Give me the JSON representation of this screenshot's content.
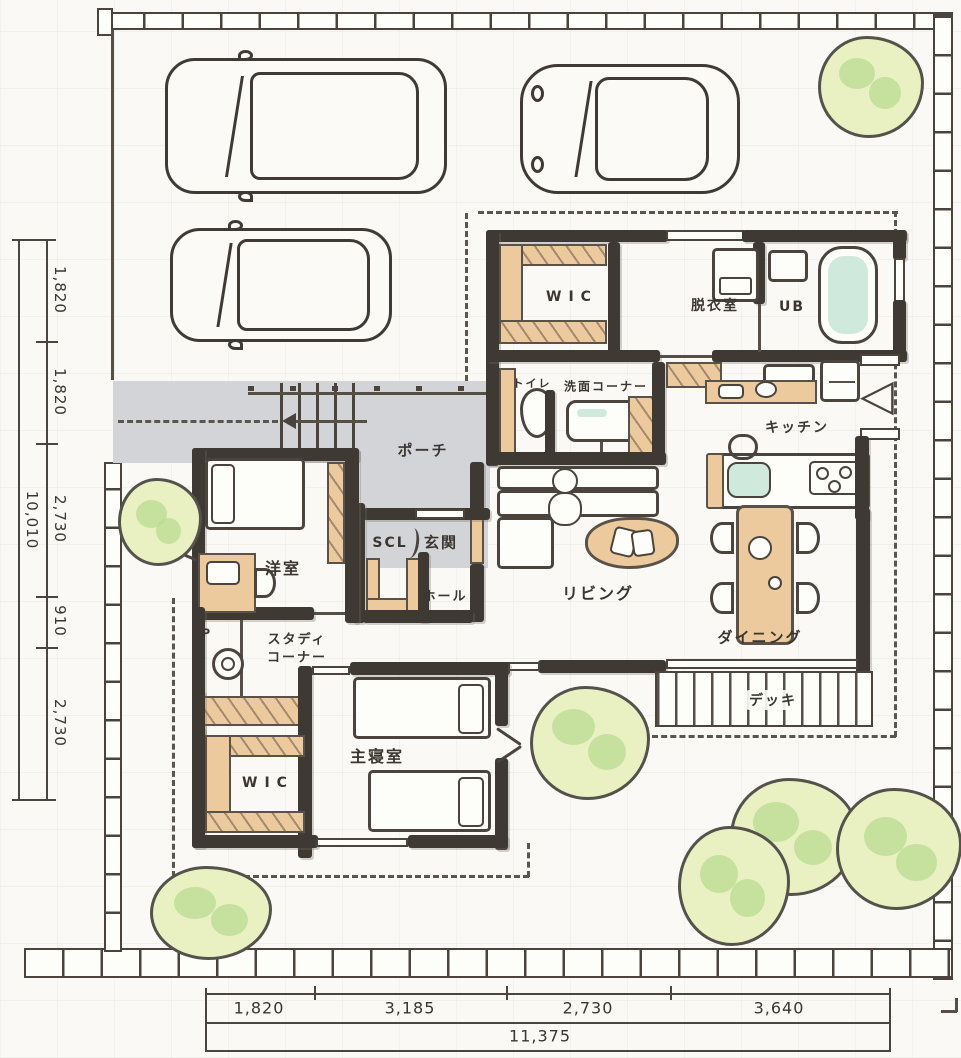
{
  "drawing_type": "hand-drawn residential floor plan (1F site plan)",
  "labels": {
    "wic_north": "WIC",
    "dressing": "脱衣室",
    "bath": "UB",
    "toilet": "トイレ",
    "washroom": "洗面コーナー",
    "kitchen": "キッチン",
    "porch": "ポーチ",
    "shoe_closet": "SCL",
    "entrance": "玄関",
    "hall": "ホール",
    "western_room": "洋室",
    "living": "リビング",
    "dining": "ダイニング",
    "study_line1": "スタディ",
    "study_line2": "コーナー",
    "master_bedroom": "主寝室",
    "wic_south": "WIC",
    "deck": "デッキ",
    "desk_mark": "P"
  },
  "dimensions": {
    "left": {
      "segments": [
        "1,820",
        "1,820",
        "2,730",
        "910",
        "2,730"
      ],
      "total": "10,010"
    },
    "bottom": {
      "segments": [
        "1,820",
        "3,185",
        "2,730",
        "3,640"
      ],
      "total": "11,375"
    }
  },
  "colors": {
    "paper": "#faf9f5",
    "wall": "#3e3933",
    "closet_tan": "#edc99e",
    "porch_gray": "#d3d4d8",
    "bathtub_mint": "#cfeadd",
    "tree_fill": "#e9f1c3",
    "tree_tint": "#b7da8e",
    "line": "#4a443c"
  }
}
